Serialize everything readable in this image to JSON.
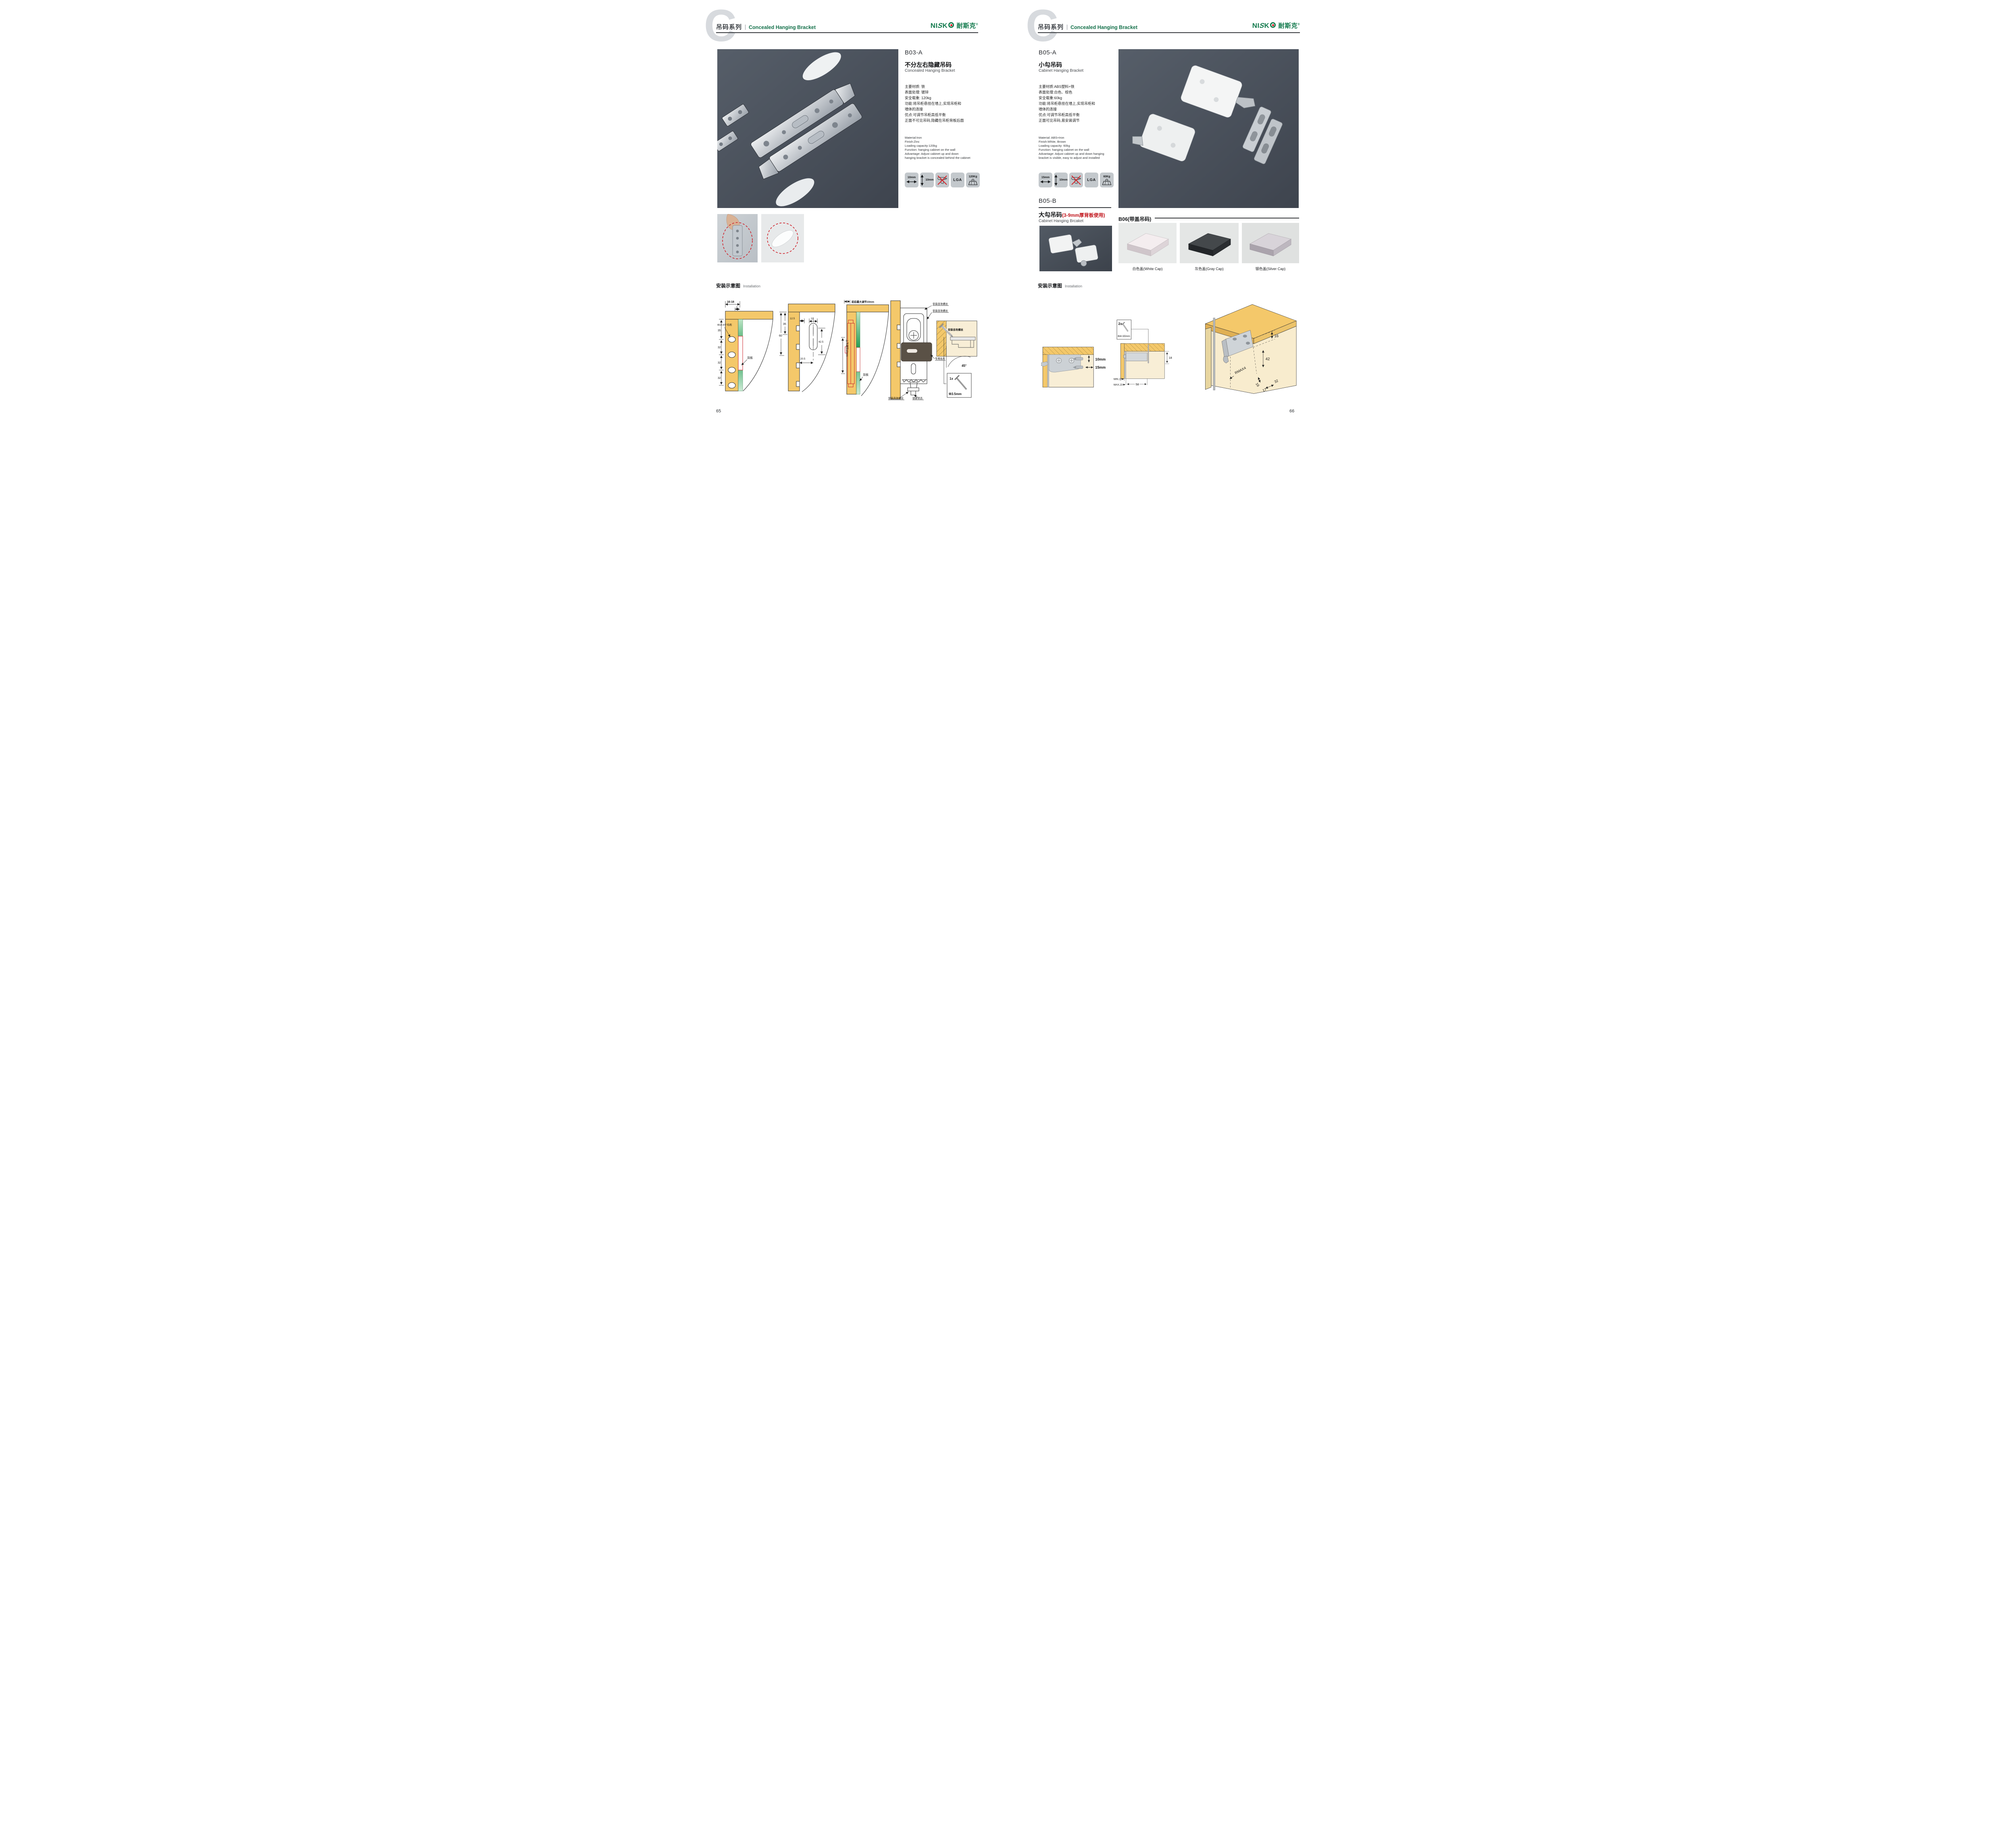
{
  "colors": {
    "brand_green": "#127a4d",
    "accent_red": "#c8232a",
    "photo_bg": "#474e59",
    "wood": "#f4c86a"
  },
  "header": {
    "watermark": "C",
    "series_cn": "吊码系列",
    "series_en": "Concealed Hanging Bracket"
  },
  "logo": {
    "latin_n": "NI",
    "latin_s": "S",
    "latin_k": "K",
    "cn": "耐斯克",
    "reg": "®"
  },
  "install": {
    "title_cn": "安装示意图",
    "title_en": "Installation"
  },
  "left": {
    "page_number": "65",
    "product": {
      "code": "B03-A",
      "name_cn": "不分左右隐藏吊码",
      "name_en": "Concealed Hanging Bracket",
      "specs_cn": [
        "主要材质: 铁",
        "表面处理: 镀锌",
        "安全载重: 120kg",
        "功能:将吊柜悬挂在墙上,实现吊柜和",
        "墙体的连接",
        "优点:可调节吊柜高低平衡",
        "正面不可见吊码,隐藏在吊柜背板后面"
      ],
      "specs_en": [
        "Material:Iron",
        "Finish:Zinc",
        "Loading capacity:120kg",
        "Function: hanging cabinet on the wall",
        "Advantage: Adjust cabinet up and down",
        "hanging bracket is concealed behind the cabinet"
      ],
      "icons": {
        "width": "10mm",
        "height": "10mm",
        "cert": "LGA",
        "weight": "120Kg"
      }
    },
    "diagrams": {
      "d1": {
        "dim_width": "16-18",
        "dim_offset": "5",
        "dim_35": "35",
        "holes": "Φ10-4个均布",
        "dim_32a": "32",
        "dim_32b": "32",
        "dim_32c": "32",
        "backboard": "背板"
      },
      "d2": {
        "dim_60": "60",
        "dim_35": "35",
        "dim_125": "12.5",
        "dim_12": "12",
        "dim_425": "42.5",
        "dim_205": "20.5"
      },
      "d3": {
        "note_top": "前后最大调节10mm",
        "note_side": "上下调节10mm",
        "backboard": "背板"
      },
      "d4": {
        "screw1": "安装自攻螺丝",
        "screw2": "安装自攻螺丝",
        "screw3": "安装自攻螺丝",
        "plate": "专用挂片",
        "lock": "锁紧状态",
        "inset_screw": "安装自攻螺丝",
        "angle": "45°",
        "qty": "1x",
        "dia": "Φ3.5mm"
      }
    }
  },
  "right": {
    "page_number": "66",
    "product": {
      "code": "B05-A",
      "name_cn": "小勾吊码",
      "name_en": "Cabinet Hanging Bracket",
      "specs_cn": [
        "主要材质:ABS塑料+铁",
        "表面处理:白色、棕色",
        "安全载重:60kg",
        "功能:将吊柜悬挂在墙上,实现吊柜和",
        "墙体的连接",
        "优点:可调节吊柜高低平衡",
        "正面可见吊码,易安装调节"
      ],
      "specs_en": [
        "Material: ABS+Iron",
        "Finish:White, Brown",
        "Loading capacity: 60kg",
        "Function: hanging cabinet on the wall",
        "Advantage: Adjust cabinet up and down hanging",
        "bracket is visible, easy to adjust and installed"
      ],
      "icons": {
        "width": "15mm",
        "height": "10mm",
        "cert": "LGA",
        "weight": "60Kg"
      }
    },
    "product_b": {
      "code": "B05-B",
      "name_cn": "大勾吊码",
      "name_note": "(3-9mm厚背板使用)",
      "name_en": "Cabinet Hanging Brcaket"
    },
    "b06": {
      "title": "B06(带盖吊码)",
      "cap1": "白色盖(White Cap)",
      "cap2": "灰色盖(Gray Cap)",
      "cap3": "银色盖(Silver Cap)"
    },
    "diagrams": {
      "r1": {
        "dim_v": "10mm",
        "dim_h": "15mm"
      },
      "r2": {
        "qty": "2x",
        "spec": "Φ4×30mm",
        "dim_18": "18",
        "dim_min": "MIN.10",
        "dim_max": "MAX.23",
        "dim_58": "58"
      },
      "r3": {
        "dim_16a": "16",
        "dim_42": "42",
        "dim_rmax": "RMAX4",
        "dim_16b": "16",
        "dim_32": "32",
        "dim_17": "17"
      }
    }
  }
}
